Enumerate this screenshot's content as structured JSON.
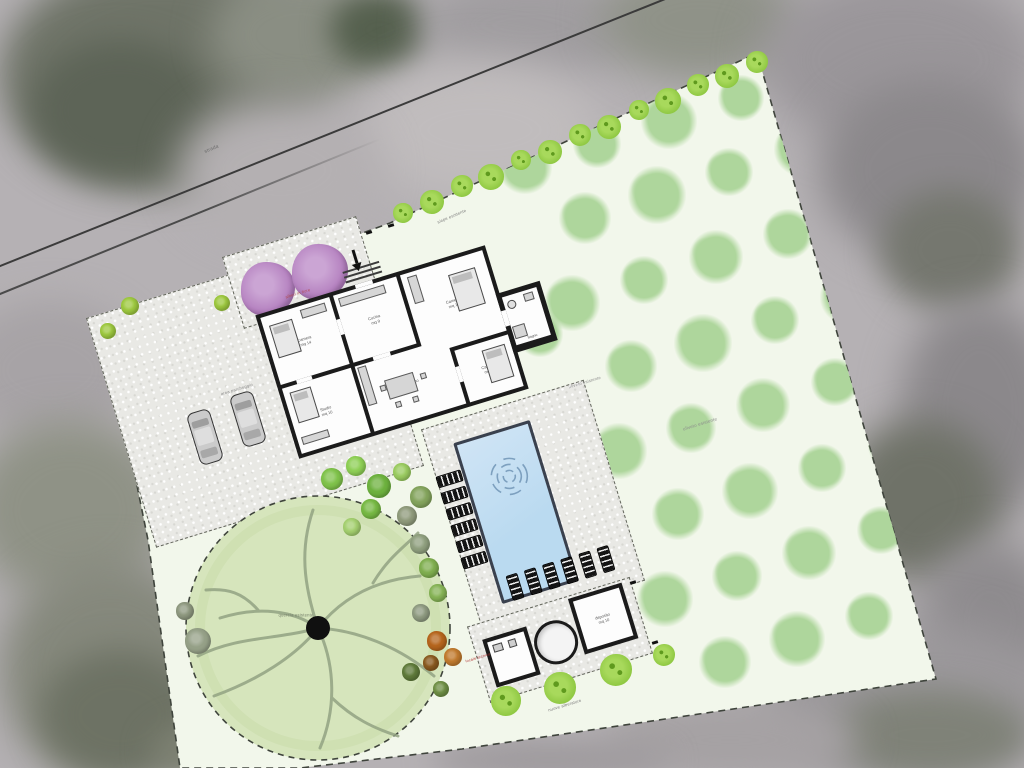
{
  "page": {
    "title": "Planimetria generale - villa con piscina e uliveto"
  },
  "colors": {
    "photo_base": "#b5b1b4",
    "site_fill": "#f2f7eb",
    "site_border": "#3f443c",
    "gravel": "#e9e9e5",
    "gravel_border": "#62655b",
    "wall": "#1b1b1b",
    "room_fill": "#fdfdfd",
    "pool_water": "#badaf0",
    "pool_edge": "#3a414e",
    "grove_tree": "#aed69c",
    "hedge_green": "#8cc63f",
    "hedge_accent": "#5f9a1e",
    "big_tree_fill": "#d6e5bc",
    "big_tree_branch": "#93a383",
    "purple_tree": "#b480bf",
    "lounger": "#141414",
    "car_body": "#cbcbcb"
  },
  "photo": {
    "base": "#b5b1b4",
    "blobs": [
      [
        0,
        -40,
        320,
        230,
        "#6f7468",
        18
      ],
      [
        30,
        40,
        180,
        140,
        "#5d6457",
        16
      ],
      [
        210,
        -30,
        180,
        130,
        "#8a8e83",
        18
      ],
      [
        330,
        -10,
        100,
        80,
        "#55604e",
        14
      ],
      [
        420,
        -30,
        220,
        110,
        "#a09da0",
        20
      ],
      [
        600,
        -40,
        200,
        120,
        "#8f9288",
        20
      ],
      [
        760,
        -30,
        280,
        180,
        "#9a969a",
        22
      ],
      [
        820,
        80,
        220,
        180,
        "#8b888b",
        20
      ],
      [
        880,
        190,
        140,
        120,
        "#75776f",
        16
      ],
      [
        900,
        300,
        160,
        220,
        "#8b888b",
        20
      ],
      [
        840,
        420,
        160,
        160,
        "#6f7268",
        18
      ],
      [
        920,
        540,
        140,
        160,
        "#8e8b8e",
        20
      ],
      [
        760,
        620,
        300,
        160,
        "#9b989b",
        22
      ],
      [
        830,
        690,
        200,
        90,
        "#7f8278",
        16
      ],
      [
        -40,
        300,
        180,
        140,
        "#a7a3a6",
        18
      ],
      [
        -30,
        420,
        200,
        180,
        "#8f9286",
        20
      ],
      [
        0,
        560,
        220,
        220,
        "#85887c",
        20
      ],
      [
        40,
        650,
        160,
        130,
        "#6d7264",
        16
      ],
      [
        150,
        720,
        140,
        60,
        "#7c8071",
        14
      ],
      [
        360,
        60,
        240,
        140,
        "#c0bcbd",
        22
      ],
      [
        180,
        100,
        200,
        140,
        "#b4b0b2",
        20
      ],
      [
        600,
        700,
        260,
        80,
        "#a5a1a3",
        18
      ],
      [
        430,
        740,
        240,
        40,
        "#9e9a9d",
        14
      ]
    ]
  },
  "roads": [
    {
      "x1": -10,
      "y1": 269,
      "x2": 670,
      "y2": -4,
      "w": 2.4,
      "color": "#3b3b3b",
      "fade": false
    },
    {
      "x1": -10,
      "y1": 297,
      "x2": 380,
      "y2": 138,
      "w": 2,
      "color": "#4a4a4a",
      "fade": true
    }
  ],
  "site": {
    "polygon": "105,327 390,223 757,53 936,679 462,749 300,768 180,768 148,540"
  },
  "paving": {
    "rects": [
      {
        "cx": 255,
        "cy": 392,
        "w": 280,
        "h": 240,
        "rot": -17
      },
      {
        "cx": 533,
        "cy": 505,
        "w": 170,
        "h": 210,
        "rot": -17
      },
      {
        "cx": 560,
        "cy": 640,
        "w": 170,
        "h": 80,
        "rot": -17
      },
      {
        "cx": 300,
        "cy": 272,
        "w": 140,
        "h": 75,
        "rot": -17
      }
    ],
    "marks": [
      [
        366,
        231
      ],
      [
        388,
        224
      ],
      [
        630,
        581
      ],
      [
        652,
        641
      ]
    ]
  },
  "grove": {
    "trees": [
      [
        525,
        167,
        27
      ],
      [
        597,
        144,
        24
      ],
      [
        669,
        121,
        28
      ],
      [
        741,
        98,
        23
      ],
      [
        585,
        218,
        26
      ],
      [
        657,
        195,
        29
      ],
      [
        729,
        172,
        24
      ],
      [
        801,
        149,
        27
      ],
      [
        572,
        303,
        28
      ],
      [
        644,
        280,
        24
      ],
      [
        716,
        257,
        27
      ],
      [
        788,
        234,
        25
      ],
      [
        631,
        366,
        26
      ],
      [
        703,
        343,
        29
      ],
      [
        775,
        320,
        24
      ],
      [
        847,
        297,
        27
      ],
      [
        619,
        451,
        28
      ],
      [
        691,
        428,
        25
      ],
      [
        763,
        405,
        27
      ],
      [
        835,
        382,
        24
      ],
      [
        678,
        514,
        26
      ],
      [
        750,
        491,
        28
      ],
      [
        822,
        468,
        24
      ],
      [
        894,
        445,
        26
      ],
      [
        665,
        599,
        28
      ],
      [
        737,
        576,
        25
      ],
      [
        809,
        553,
        27
      ],
      [
        881,
        530,
        24
      ],
      [
        725,
        662,
        26
      ],
      [
        797,
        639,
        28
      ],
      [
        869,
        616,
        24
      ],
      [
        540,
        334,
        23
      ]
    ]
  },
  "hedges": {
    "top": [
      [
        403,
        213,
        10
      ],
      [
        432,
        202,
        12
      ],
      [
        462,
        186,
        11
      ],
      [
        491,
        177,
        13
      ],
      [
        521,
        160,
        10
      ],
      [
        550,
        152,
        12
      ],
      [
        580,
        135,
        11
      ],
      [
        609,
        127,
        12
      ],
      [
        639,
        110,
        10
      ],
      [
        668,
        101,
        13
      ],
      [
        698,
        85,
        11
      ],
      [
        727,
        76,
        12
      ],
      [
        757,
        62,
        11
      ]
    ],
    "bottom": [
      [
        506,
        701,
        15
      ],
      [
        560,
        688,
        16
      ],
      [
        616,
        670,
        16
      ],
      [
        664,
        655,
        11
      ]
    ]
  },
  "bushes": [
    [
      332,
      479,
      11,
      "#7fc24a"
    ],
    [
      356,
      466,
      10,
      "#8ecf55"
    ],
    [
      379,
      486,
      12,
      "#6db13e"
    ],
    [
      402,
      472,
      9,
      "#9acb60"
    ],
    [
      421,
      497,
      11,
      "#83a35c"
    ],
    [
      407,
      516,
      10,
      "#8f9a7b"
    ],
    [
      371,
      509,
      10,
      "#76b843"
    ],
    [
      352,
      527,
      9,
      "#a4cf6f"
    ],
    [
      420,
      544,
      10,
      "#8f9f7e"
    ],
    [
      429,
      568,
      10,
      "#7fae4f"
    ],
    [
      438,
      593,
      9,
      "#86b356"
    ],
    [
      421,
      613,
      9,
      "#8e9a80"
    ],
    [
      437,
      641,
      10,
      "#b5651d"
    ],
    [
      453,
      657,
      9,
      "#c07a2e"
    ],
    [
      431,
      663,
      8,
      "#8a5a20"
    ],
    [
      411,
      672,
      9,
      "#5f7a3a"
    ],
    [
      441,
      689,
      8,
      "#6f8f45"
    ],
    [
      198,
      641,
      13,
      "#95a087"
    ],
    [
      185,
      611,
      9,
      "#8e987f"
    ],
    [
      222,
      303,
      8,
      "#9dc83f"
    ],
    [
      108,
      331,
      8,
      "#9dc83f"
    ],
    [
      130,
      306,
      9,
      "#9dc83f"
    ]
  ],
  "big_tree": {
    "cx": 318,
    "cy": 628,
    "r": 132
  },
  "purple_trees": {
    "items": [
      [
        268,
        289,
        27
      ],
      [
        320,
        272,
        28
      ]
    ]
  },
  "pool": {
    "cx": 516,
    "cy": 512,
    "w": 80,
    "h": 168,
    "rot": -17
  },
  "lounger_groups": [
    {
      "cx": 462,
      "cy": 519,
      "rot": -17,
      "count": 6,
      "dx": 0,
      "dy": 17,
      "w": 26,
      "h": 12
    },
    {
      "cx": 560,
      "cy": 573,
      "rot": -17,
      "count": 6,
      "dx": 19,
      "dy": 0,
      "w": 12,
      "h": 26
    }
  ],
  "cars": [
    {
      "cx": 205,
      "cy": 437,
      "rot": -17
    },
    {
      "cx": 248,
      "cy": 419,
      "rot": -17
    }
  ],
  "house": {
    "cx": 392,
    "cy": 352,
    "w": 240,
    "h": 150,
    "rot": -17,
    "rooms": [
      {
        "x": 4,
        "y": 4,
        "w": 72,
        "h": 70,
        "name": "Camera",
        "area": "mq 14"
      },
      {
        "x": 80,
        "y": 4,
        "w": 66,
        "h": 70,
        "name": "Cucina",
        "area": "mq 9"
      },
      {
        "x": 150,
        "y": 4,
        "w": 86,
        "h": 84,
        "name": "Camera",
        "area": "mq 16"
      },
      {
        "x": 80,
        "y": 78,
        "w": 96,
        "h": 68,
        "name": "Soggiorno",
        "area": "mq 28"
      },
      {
        "x": 180,
        "y": 92,
        "w": 56,
        "h": 54,
        "name": "Camera",
        "area": "mq 12"
      },
      {
        "x": 4,
        "y": 78,
        "w": 72,
        "h": 68,
        "name": "Studio",
        "area": "mq 10"
      }
    ],
    "annex": {
      "x": 236,
      "y": 50,
      "w": 46,
      "h": 62,
      "name": "Bagno",
      "area": "mq 5"
    },
    "doors": [
      [
        76,
        28,
        4,
        16
      ],
      [
        100,
        74,
        18,
        4
      ],
      [
        176,
        108,
        4,
        16
      ],
      [
        155,
        88,
        16,
        4
      ],
      [
        20,
        74,
        16,
        4
      ],
      [
        104,
        0,
        18,
        4
      ],
      [
        236,
        68,
        5,
        16
      ]
    ],
    "furniture": [
      [
        "bed",
        10,
        14,
        24,
        34
      ],
      [
        "bed",
        196,
        18,
        28,
        38
      ],
      [
        "bed",
        206,
        100,
        24,
        34
      ],
      [
        "bed",
        10,
        84,
        22,
        32
      ],
      [
        "rect",
        44,
        8,
        26,
        9
      ],
      [
        "rect",
        156,
        8,
        10,
        28
      ],
      [
        "rect",
        84,
        8,
        48,
        9
      ],
      [
        "table",
        104,
        100,
        30,
        20
      ],
      [
        "rect",
        82,
        80,
        9,
        40
      ],
      [
        "rect",
        8,
        130,
        28,
        8
      ],
      [
        "rect",
        98,
        104,
        6,
        6
      ],
      [
        "rect",
        140,
        104,
        6,
        6
      ],
      [
        "rect",
        108,
        124,
        6,
        6
      ],
      [
        "rect",
        126,
        124,
        6,
        6
      ],
      [
        "circ",
        244,
        60,
        9,
        0
      ],
      [
        "rect",
        262,
        58,
        10,
        8
      ],
      [
        "rect",
        242,
        86,
        13,
        13
      ]
    ]
  },
  "pool_house": {
    "cx": 560,
    "cy": 638,
    "w": 150,
    "h": 70,
    "rot": -17,
    "store_label": {
      "name": "deposito",
      "area": "mq 10"
    }
  },
  "labels": [
    {
      "text": "strada",
      "x": 212,
      "y": 150,
      "rot": -23,
      "size": 5,
      "color": "#6d6d6d"
    },
    {
      "text": "siepe esistente",
      "x": 452,
      "y": 217,
      "rot": -23,
      "size": 4.2,
      "color": "#7a7a7a"
    },
    {
      "text": "uliveto esistente",
      "x": 700,
      "y": 424,
      "rot": -17,
      "size": 4.5,
      "color": "#8a8a8a"
    },
    {
      "text": "uliveto esistente",
      "x": 585,
      "y": 383,
      "rot": -17,
      "size": 4.2,
      "color": "#8a8a8a"
    },
    {
      "text": "area parcheggio",
      "x": 237,
      "y": 390,
      "rot": -17,
      "size": 4.2,
      "color": "#8a8a8a"
    },
    {
      "text": "alberi in fiore",
      "x": 298,
      "y": 294,
      "rot": -17,
      "size": 4,
      "color": "#b24a52"
    },
    {
      "text": "quercia esistente",
      "x": 296,
      "y": 616,
      "rot": 0,
      "size": 4.2,
      "color": "#76806a"
    },
    {
      "text": "nuove alberature",
      "x": 565,
      "y": 706,
      "rot": -17,
      "size": 4.2,
      "color": "#7a7a7a"
    },
    {
      "text": "locale tecnico",
      "x": 478,
      "y": 658,
      "rot": -17,
      "size": 3.8,
      "color": "#b03030"
    }
  ]
}
